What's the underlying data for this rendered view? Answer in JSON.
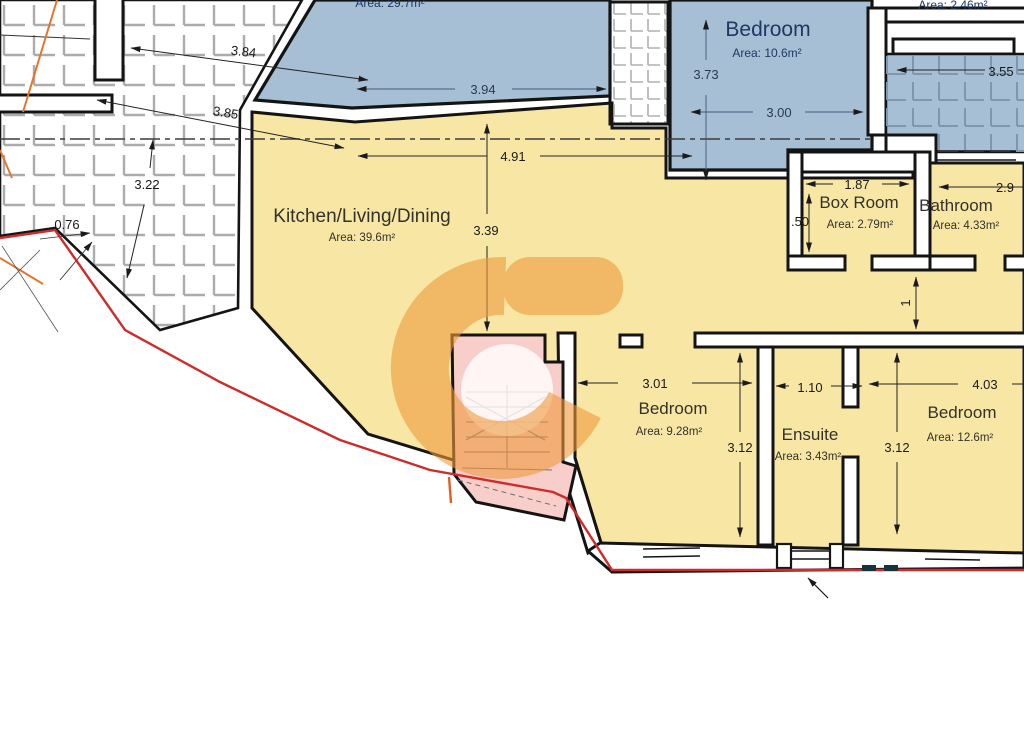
{
  "document": {
    "type": "architectural-floor-plan"
  },
  "colors": {
    "room_yellow": "#F8E7A4",
    "room_blue": "#A6BFD4",
    "stairs_pink": "#F7CEC9",
    "boundary_red": "#CE2B2B",
    "watermark_orange": "#EE9A3C",
    "navy_text": "#1F3864",
    "wall_black": "#141414"
  },
  "rooms": {
    "lounge": {
      "area": "Area: 29.7m²"
    },
    "bedroom_top": {
      "label": "Bedroom",
      "area": "Area: 10.6m²"
    },
    "terrace": {
      "area": "Area: 2.46m²"
    },
    "kitchen": {
      "label": "Kitchen/Living/Dining",
      "area": "Area: 39.6m²"
    },
    "box_room": {
      "label": "Box Room",
      "area": "Area: 2.79m²"
    },
    "bathroom": {
      "label": "Bathroom",
      "area": "Area: 4.33m²"
    },
    "bedroom_1": {
      "label": "Bedroom",
      "area": "Area: 9.28m²"
    },
    "ensuite": {
      "label": "Ensuite",
      "area": "Area: 3.43m²"
    },
    "bedroom_2": {
      "label": "Bedroom",
      "area": "Area: 12.6m²"
    }
  },
  "dimensions": {
    "d384": "3.84",
    "d385": "3.85",
    "d394": "3.94",
    "d491": "4.91",
    "d373": "3.73",
    "d300": "3.00",
    "d322": "3.22",
    "d339": "3.39",
    "d076": "0.76",
    "d187": "1.87",
    "d050": ".50",
    "d29": "2.9",
    "d355": "3.55",
    "d1": "1",
    "d301": "3.01",
    "d312a": "3.12",
    "d110": "1.10",
    "d403": "4.03",
    "d312b": "3.12"
  }
}
